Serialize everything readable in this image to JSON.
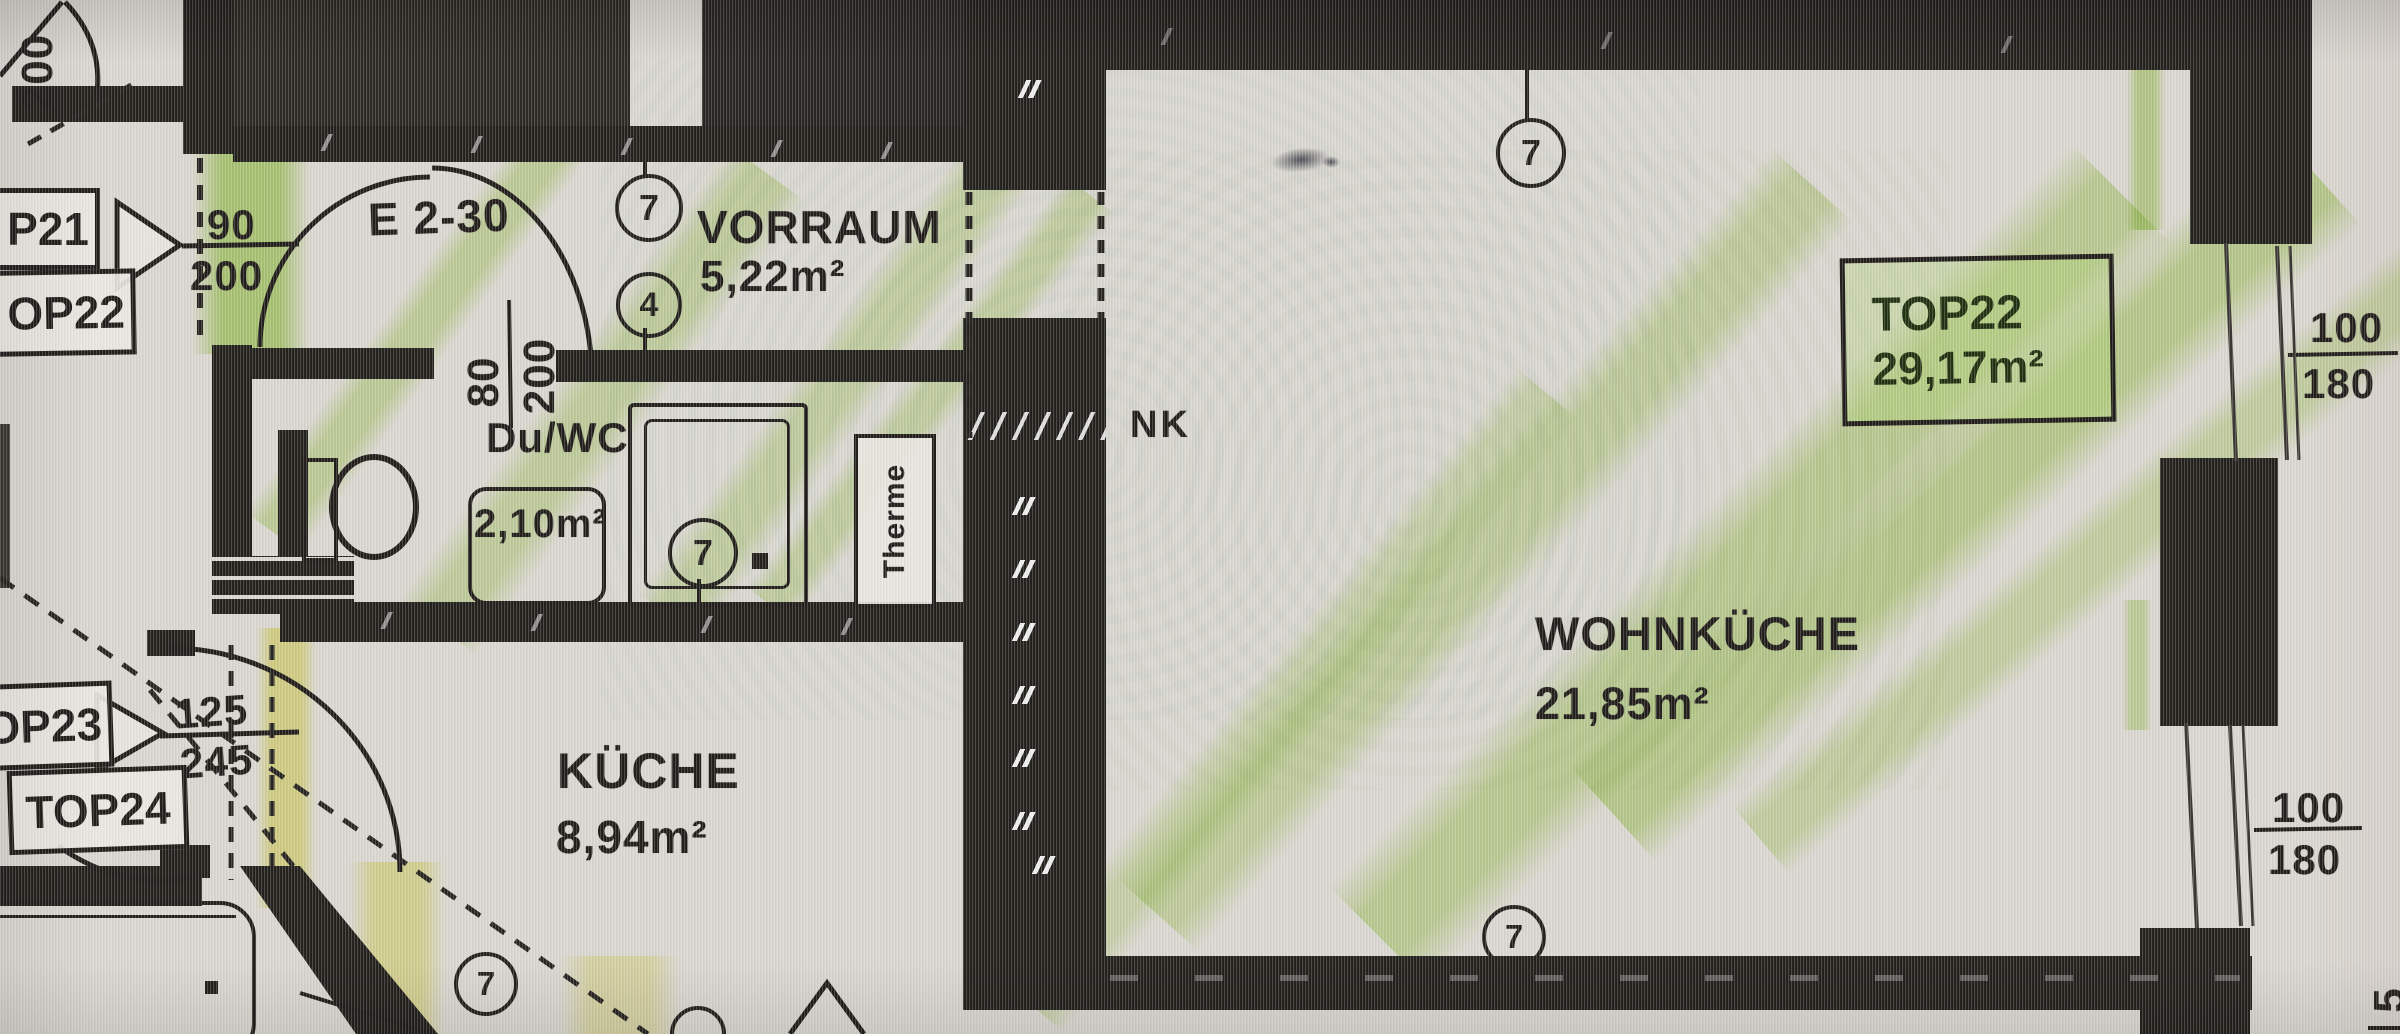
{
  "colors": {
    "wall": "#221f1b",
    "paper": "#d9d6cf",
    "highlight_green": "#96cd2d",
    "highlight_yellow": "#e8e44c",
    "badge_tint": "#aacf6a"
  },
  "corner_dim": "200",
  "unit_boxes": {
    "top21": "P21",
    "top22": "OP22",
    "top23": "OP23",
    "top24": "TOP24"
  },
  "doors": {
    "entrance_label": "E 2-30",
    "d90": {
      "num": "90",
      "den": "200"
    },
    "d80": {
      "num": "80",
      "den": "200"
    },
    "d125": {
      "num": "125",
      "den": "245"
    }
  },
  "windows": {
    "w1": {
      "num": "100",
      "den": "180"
    },
    "w2": {
      "num": "100",
      "den": "180"
    }
  },
  "rooms": {
    "vorraum": {
      "name": "VORRAUM",
      "area": "5,22m²"
    },
    "duwc": {
      "name": "Du/WC",
      "area": "2,10m²"
    },
    "kueche": {
      "name": "KÜCHE",
      "area": "8,94m²"
    },
    "wohnkueche": {
      "name": "WOHNKÜCHE",
      "area": "21,85m²"
    }
  },
  "badge": {
    "label": "TOP22",
    "area": "29,17m²"
  },
  "labels": {
    "nk": "NK",
    "therme": "Therme",
    "edge_partial": "5"
  },
  "markers": {
    "seven": "7",
    "four": "4"
  }
}
